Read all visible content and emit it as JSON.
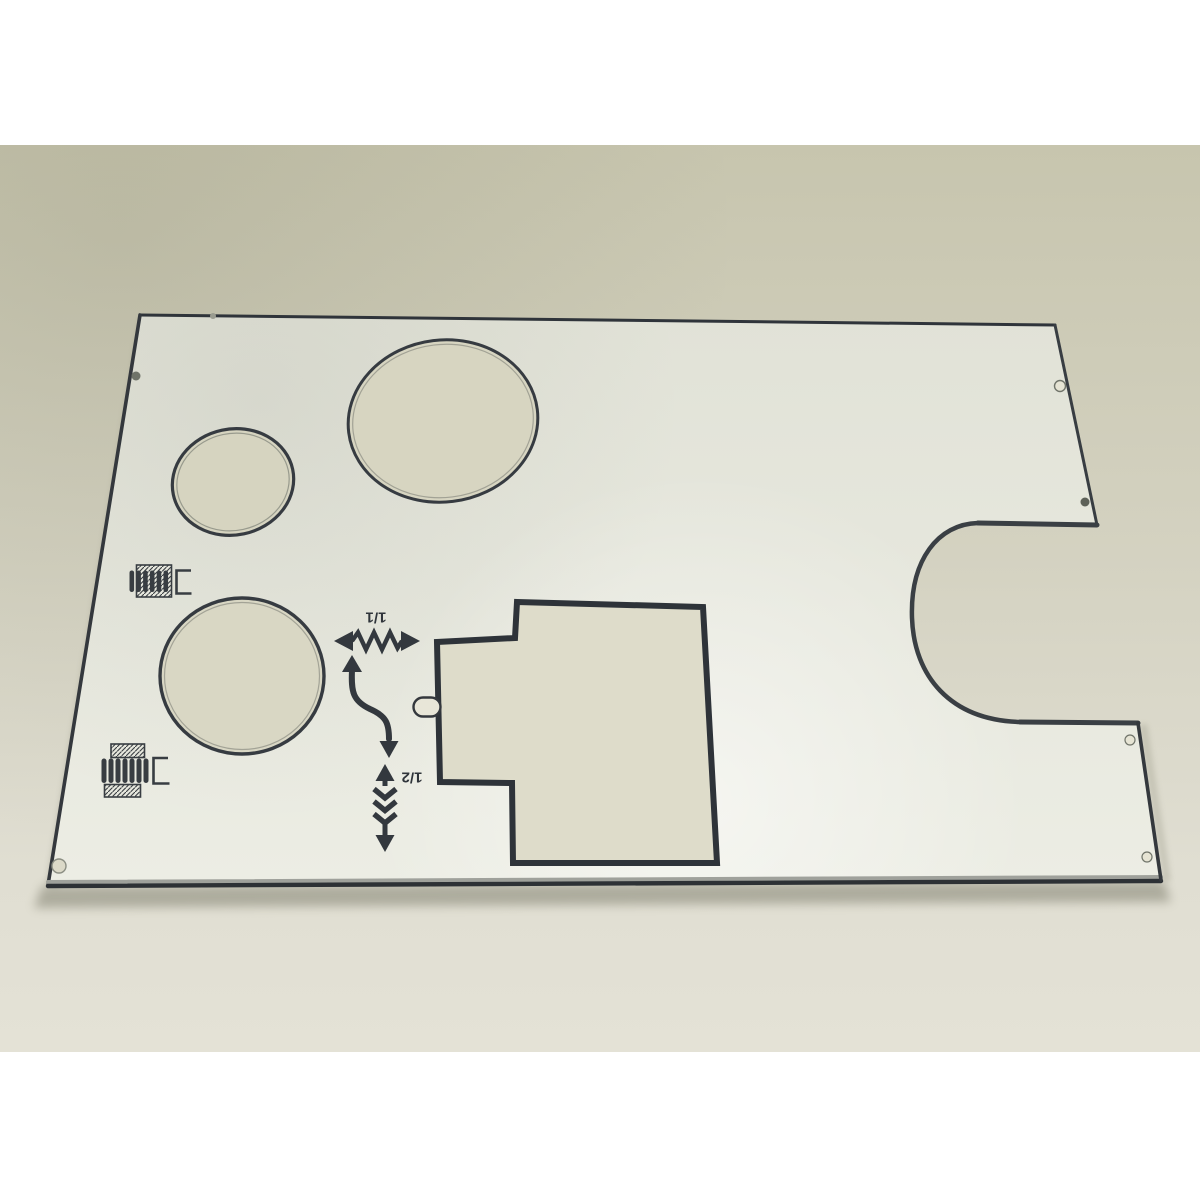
{
  "photo": {
    "subject": "Sewing machine bottom cover plate lying on a beige table",
    "labels": {
      "ratio_full": "1/1",
      "ratio_half": "1/2"
    },
    "markings": [
      "thread-tension-coil-icon-small",
      "thread-tension-coil-icon-large",
      "zigzag-width-double-arrow",
      "curved-transfer-arrow",
      "zigzag-length-arrow"
    ],
    "cutouts": [
      "small-round-hole",
      "large-oval-hole",
      "large-round-hole",
      "stepped-rectangular-hole",
      "small-slot-hole",
      "right-edge-semicircular-notch"
    ],
    "screw_holes": 7
  },
  "colors": {
    "margin_white": "#ffffff",
    "table_top": "#c7c5ae",
    "table_bottom": "#e4e2d6",
    "plate_light": "#ecede4",
    "plate_dark": "#e1e2d7",
    "edge_dark": "#343a41",
    "print_dark": "#33383e",
    "hole_showthrough": "#dbd9c6"
  }
}
